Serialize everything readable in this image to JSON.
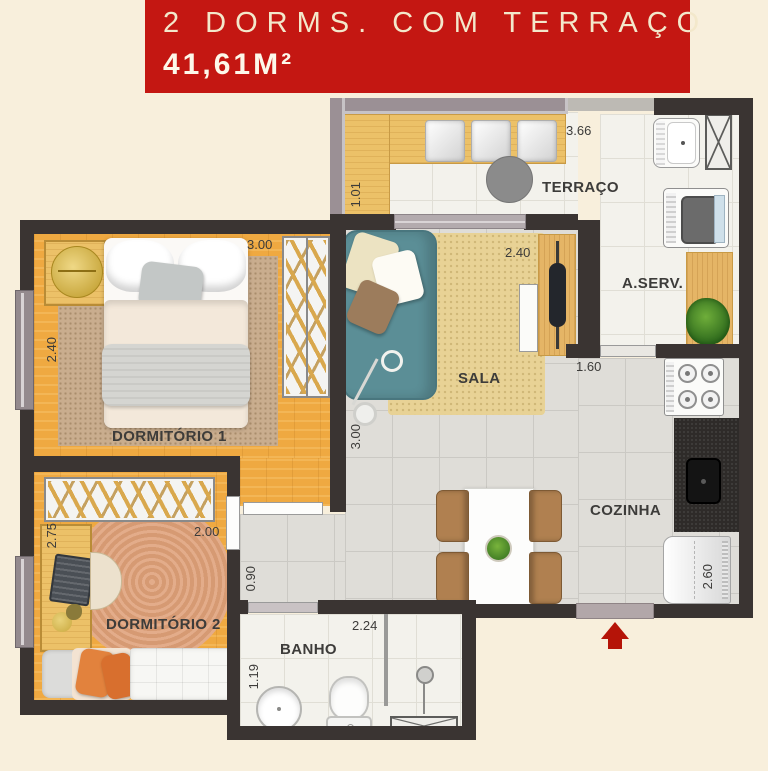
{
  "header": {
    "title": "2 DORMS. COM TERRAÇO",
    "area": "41,61M²",
    "banner_color": "#c41712",
    "banner_text_color": "#f4e9ce"
  },
  "rooms": {
    "terraco": {
      "label": "TERRAÇO",
      "dim_width": "3.66",
      "dim_depth": "1.01"
    },
    "aserv": {
      "label": "A.SERV."
    },
    "sala": {
      "label": "SALA",
      "dim_width": "2.40",
      "dim_depth": "3.00"
    },
    "dorm1": {
      "label": "DORMITÓRIO 1",
      "dim_width": "3.00",
      "dim_depth": "2.40"
    },
    "dorm2": {
      "label": "DORMITÓRIO 2",
      "dim_width": "2.00",
      "dim_depth": "2.75"
    },
    "hall": {
      "dim_width": "0.90"
    },
    "banho": {
      "label": "BANHO",
      "dim_width": "2.24",
      "dim_depth": "1.19"
    },
    "cozinha": {
      "label": "COZINHA",
      "dim_width": "1.60",
      "dim_depth": "2.60"
    }
  },
  "colors": {
    "wall": "#3a3432",
    "wood_floor": "#efa941",
    "tile_gray": "#dfddd8",
    "tile_light": "#f3f2ec",
    "sofa_teal": "#5b8e96",
    "entry_arrow_red": "#b51408",
    "background_cream": "#f8efdc"
  }
}
